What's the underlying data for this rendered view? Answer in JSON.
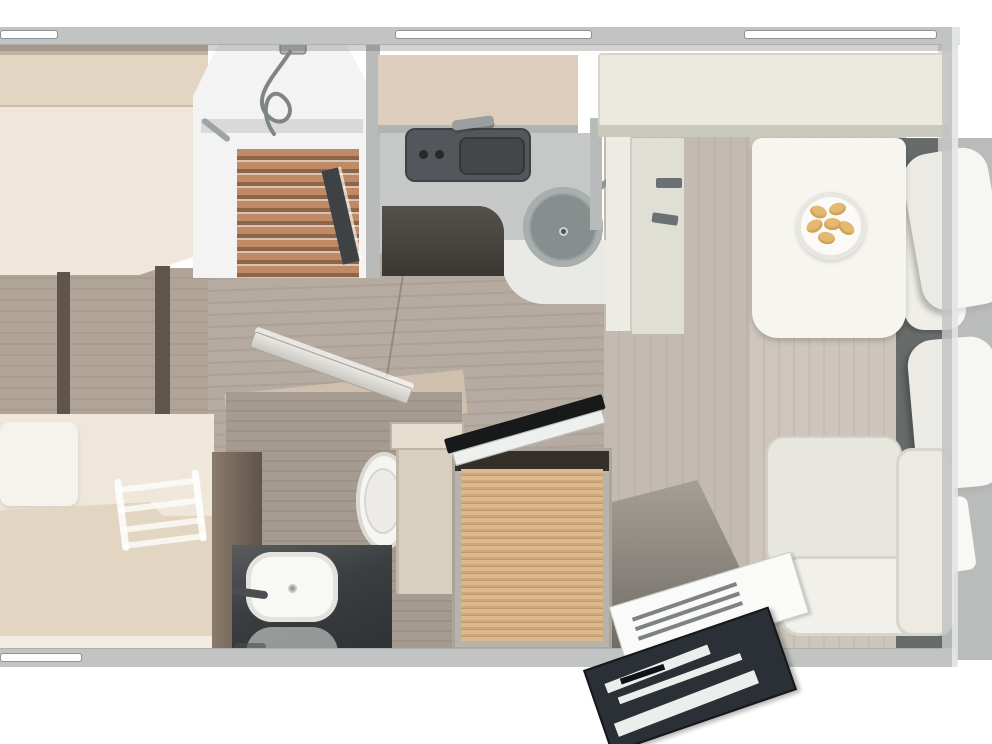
{
  "meta": {
    "description": "Top-down 3D rendered floor plan of a motorhome interior, no visible text",
    "canvas": {
      "width": 992,
      "height": 744
    }
  },
  "palette": {
    "wall": "#c2c4c3",
    "window": "#fdfdfd",
    "bedding": "#efe8da",
    "blanket": "#e2d5c2",
    "pillow": "#f6f3ec",
    "floor-left": "#b0a497",
    "floor-mid": "#b6aba0",
    "floor-right": "#c3bbb1",
    "floor-light": "#cfc7bd",
    "floor-bath": "#a69b90",
    "bath-wall": "#cfc0ae",
    "shower-wall": "#f2f3f2",
    "slat-light": "#c08a67",
    "slat-dark": "#8f654a",
    "glass-frame": "#3f4244",
    "overhead": "#dccdbc",
    "counter": "#c6c8c7",
    "stove": "#53565a",
    "sink-rim": "#9aa0a0",
    "sink-bowl": "#878e8e",
    "dropbed": "#ebe9dd",
    "table": "#f6f5f0",
    "plate": "#fbfaf7",
    "croissant": "#e5b96f",
    "croissant-sh": "#c99a52",
    "cab-floor": "#676b6a",
    "seat": "#eceae4",
    "partition": "#5f554a",
    "cab-cream": "#d8cfc0",
    "door": "#c9c7c1",
    "gloss": "#2f3234",
    "basin": "#f8f8f5",
    "wood": "#dcba8e",
    "tv": "#17191b",
    "mag": "#2b3036"
  },
  "furniture": [
    "front-bed",
    "rear-bed",
    "bunk-ladder",
    "shower-cabin",
    "shower-hose",
    "kitchen-overhead-locker",
    "hob",
    "kitchen-sink",
    "drop-down-bed",
    "dinette-bench",
    "dinette-table",
    "plate-of-croissants",
    "cab-seats",
    "rear-lounge-bench",
    "toilet",
    "washbasin",
    "bathroom-door",
    "wardrobe",
    "flatscreen-tv",
    "magazines",
    "windows"
  ]
}
